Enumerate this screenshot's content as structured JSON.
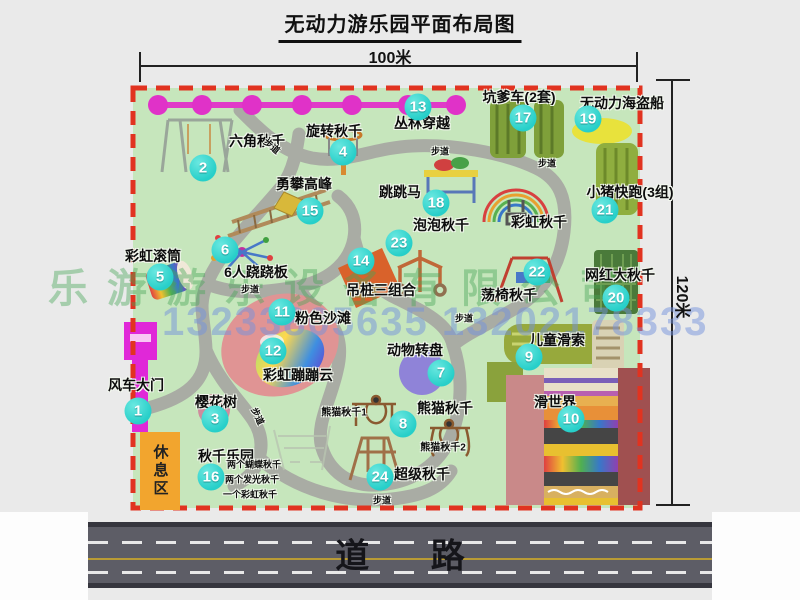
{
  "title": "无动力游乐园平面布局图",
  "dimensions": {
    "top": "100米",
    "right": "120米"
  },
  "road": {
    "label": "道  路"
  },
  "rest_area": {
    "label": "休息区"
  },
  "watermark": {
    "company": "乐游游乐设备有限公司",
    "phone": "13233805635 13202178333"
  },
  "colors": {
    "park_green": "#c6e6bc",
    "path_gray": "#a9aca4",
    "border_red": "#e13320",
    "zipline_magenta": "#e03ac8",
    "marker_cyan": "#27cfc9",
    "rest_orange": "#f2a52e",
    "road_gray": "#5d5d66",
    "road_yellow": "#b99b35"
  },
  "markers": [
    {
      "num": "1",
      "x": 138,
      "y": 411
    },
    {
      "num": "2",
      "x": 203,
      "y": 168
    },
    {
      "num": "3",
      "x": 215,
      "y": 419
    },
    {
      "num": "4",
      "x": 343,
      "y": 152
    },
    {
      "num": "5",
      "x": 160,
      "y": 277
    },
    {
      "num": "6",
      "x": 225,
      "y": 250
    },
    {
      "num": "7",
      "x": 441,
      "y": 373
    },
    {
      "num": "8",
      "x": 403,
      "y": 424
    },
    {
      "num": "9",
      "x": 529,
      "y": 357
    },
    {
      "num": "10",
      "x": 571,
      "y": 419
    },
    {
      "num": "11",
      "x": 282,
      "y": 312
    },
    {
      "num": "12",
      "x": 273,
      "y": 351
    },
    {
      "num": "13",
      "x": 418,
      "y": 107
    },
    {
      "num": "14",
      "x": 361,
      "y": 261
    },
    {
      "num": "15",
      "x": 310,
      "y": 211
    },
    {
      "num": "16",
      "x": 211,
      "y": 477
    },
    {
      "num": "17",
      "x": 523,
      "y": 118
    },
    {
      "num": "18",
      "x": 436,
      "y": 203
    },
    {
      "num": "19",
      "x": 588,
      "y": 119
    },
    {
      "num": "20",
      "x": 616,
      "y": 298
    },
    {
      "num": "21",
      "x": 605,
      "y": 210
    },
    {
      "num": "22",
      "x": 537,
      "y": 272
    },
    {
      "num": "23",
      "x": 399,
      "y": 243
    },
    {
      "num": "24",
      "x": 380,
      "y": 477
    }
  ],
  "labels": [
    {
      "text": "风车大门",
      "x": 136,
      "y": 385
    },
    {
      "text": "六角秋千",
      "x": 257,
      "y": 141
    },
    {
      "text": "旋转秋千",
      "x": 334,
      "y": 131
    },
    {
      "text": "丛林穿越",
      "x": 422,
      "y": 123
    },
    {
      "text": "坑爹车(2套)",
      "x": 519,
      "y": 97
    },
    {
      "text": "无动力海盗船",
      "x": 622,
      "y": 103
    },
    {
      "text": "勇攀高峰",
      "x": 304,
      "y": 184
    },
    {
      "text": "小猪快跑(3组)",
      "x": 630,
      "y": 192
    },
    {
      "text": "跳跳马",
      "x": 400,
      "y": 192
    },
    {
      "text": "彩虹秋千",
      "x": 539,
      "y": 222
    },
    {
      "text": "泡泡秋千",
      "x": 441,
      "y": 225
    },
    {
      "text": "彩虹滚筒",
      "x": 153,
      "y": 256
    },
    {
      "text": "6人跷跷板",
      "x": 256,
      "y": 272
    },
    {
      "text": "吊桩三组合",
      "x": 381,
      "y": 290
    },
    {
      "text": "网红大秋千",
      "x": 620,
      "y": 275
    },
    {
      "text": "荡椅秋千",
      "x": 509,
      "y": 295
    },
    {
      "text": "粉色沙滩",
      "x": 323,
      "y": 318
    },
    {
      "text": "动物转盘",
      "x": 415,
      "y": 350
    },
    {
      "text": "儿童滑索",
      "x": 557,
      "y": 340
    },
    {
      "text": "彩虹蹦蹦云",
      "x": 298,
      "y": 375
    },
    {
      "text": "樱花树",
      "x": 216,
      "y": 402
    },
    {
      "text": "滑世界",
      "x": 555,
      "y": 402
    },
    {
      "text": "熊猫秋千",
      "x": 445,
      "y": 408
    },
    {
      "text": "秋千乐园",
      "x": 226,
      "y": 456
    },
    {
      "text": "超级秋千",
      "x": 422,
      "y": 474
    },
    {
      "text": "熊猫秋千1",
      "x": 344,
      "y": 411,
      "size": 10
    },
    {
      "text": "熊猫秋千2",
      "x": 443,
      "y": 446,
      "size": 10
    },
    {
      "text": "两个蝴蝶秋千",
      "x": 254,
      "y": 464,
      "size": 9
    },
    {
      "text": "两个发光秋千",
      "x": 252,
      "y": 479,
      "size": 9
    },
    {
      "text": "一个彩虹秋千",
      "x": 250,
      "y": 494,
      "size": 9
    },
    {
      "text": "步道",
      "x": 272,
      "y": 146,
      "size": 9,
      "rotate": 40
    },
    {
      "text": "步道",
      "x": 440,
      "y": 151,
      "size": 9
    },
    {
      "text": "步道",
      "x": 547,
      "y": 163,
      "size": 9
    },
    {
      "text": "步道",
      "x": 250,
      "y": 289,
      "size": 9
    },
    {
      "text": "步道",
      "x": 464,
      "y": 318,
      "size": 9
    },
    {
      "text": "步道",
      "x": 258,
      "y": 416,
      "size": 9,
      "rotate": 65
    },
    {
      "text": "步道",
      "x": 382,
      "y": 500,
      "size": 9
    }
  ]
}
